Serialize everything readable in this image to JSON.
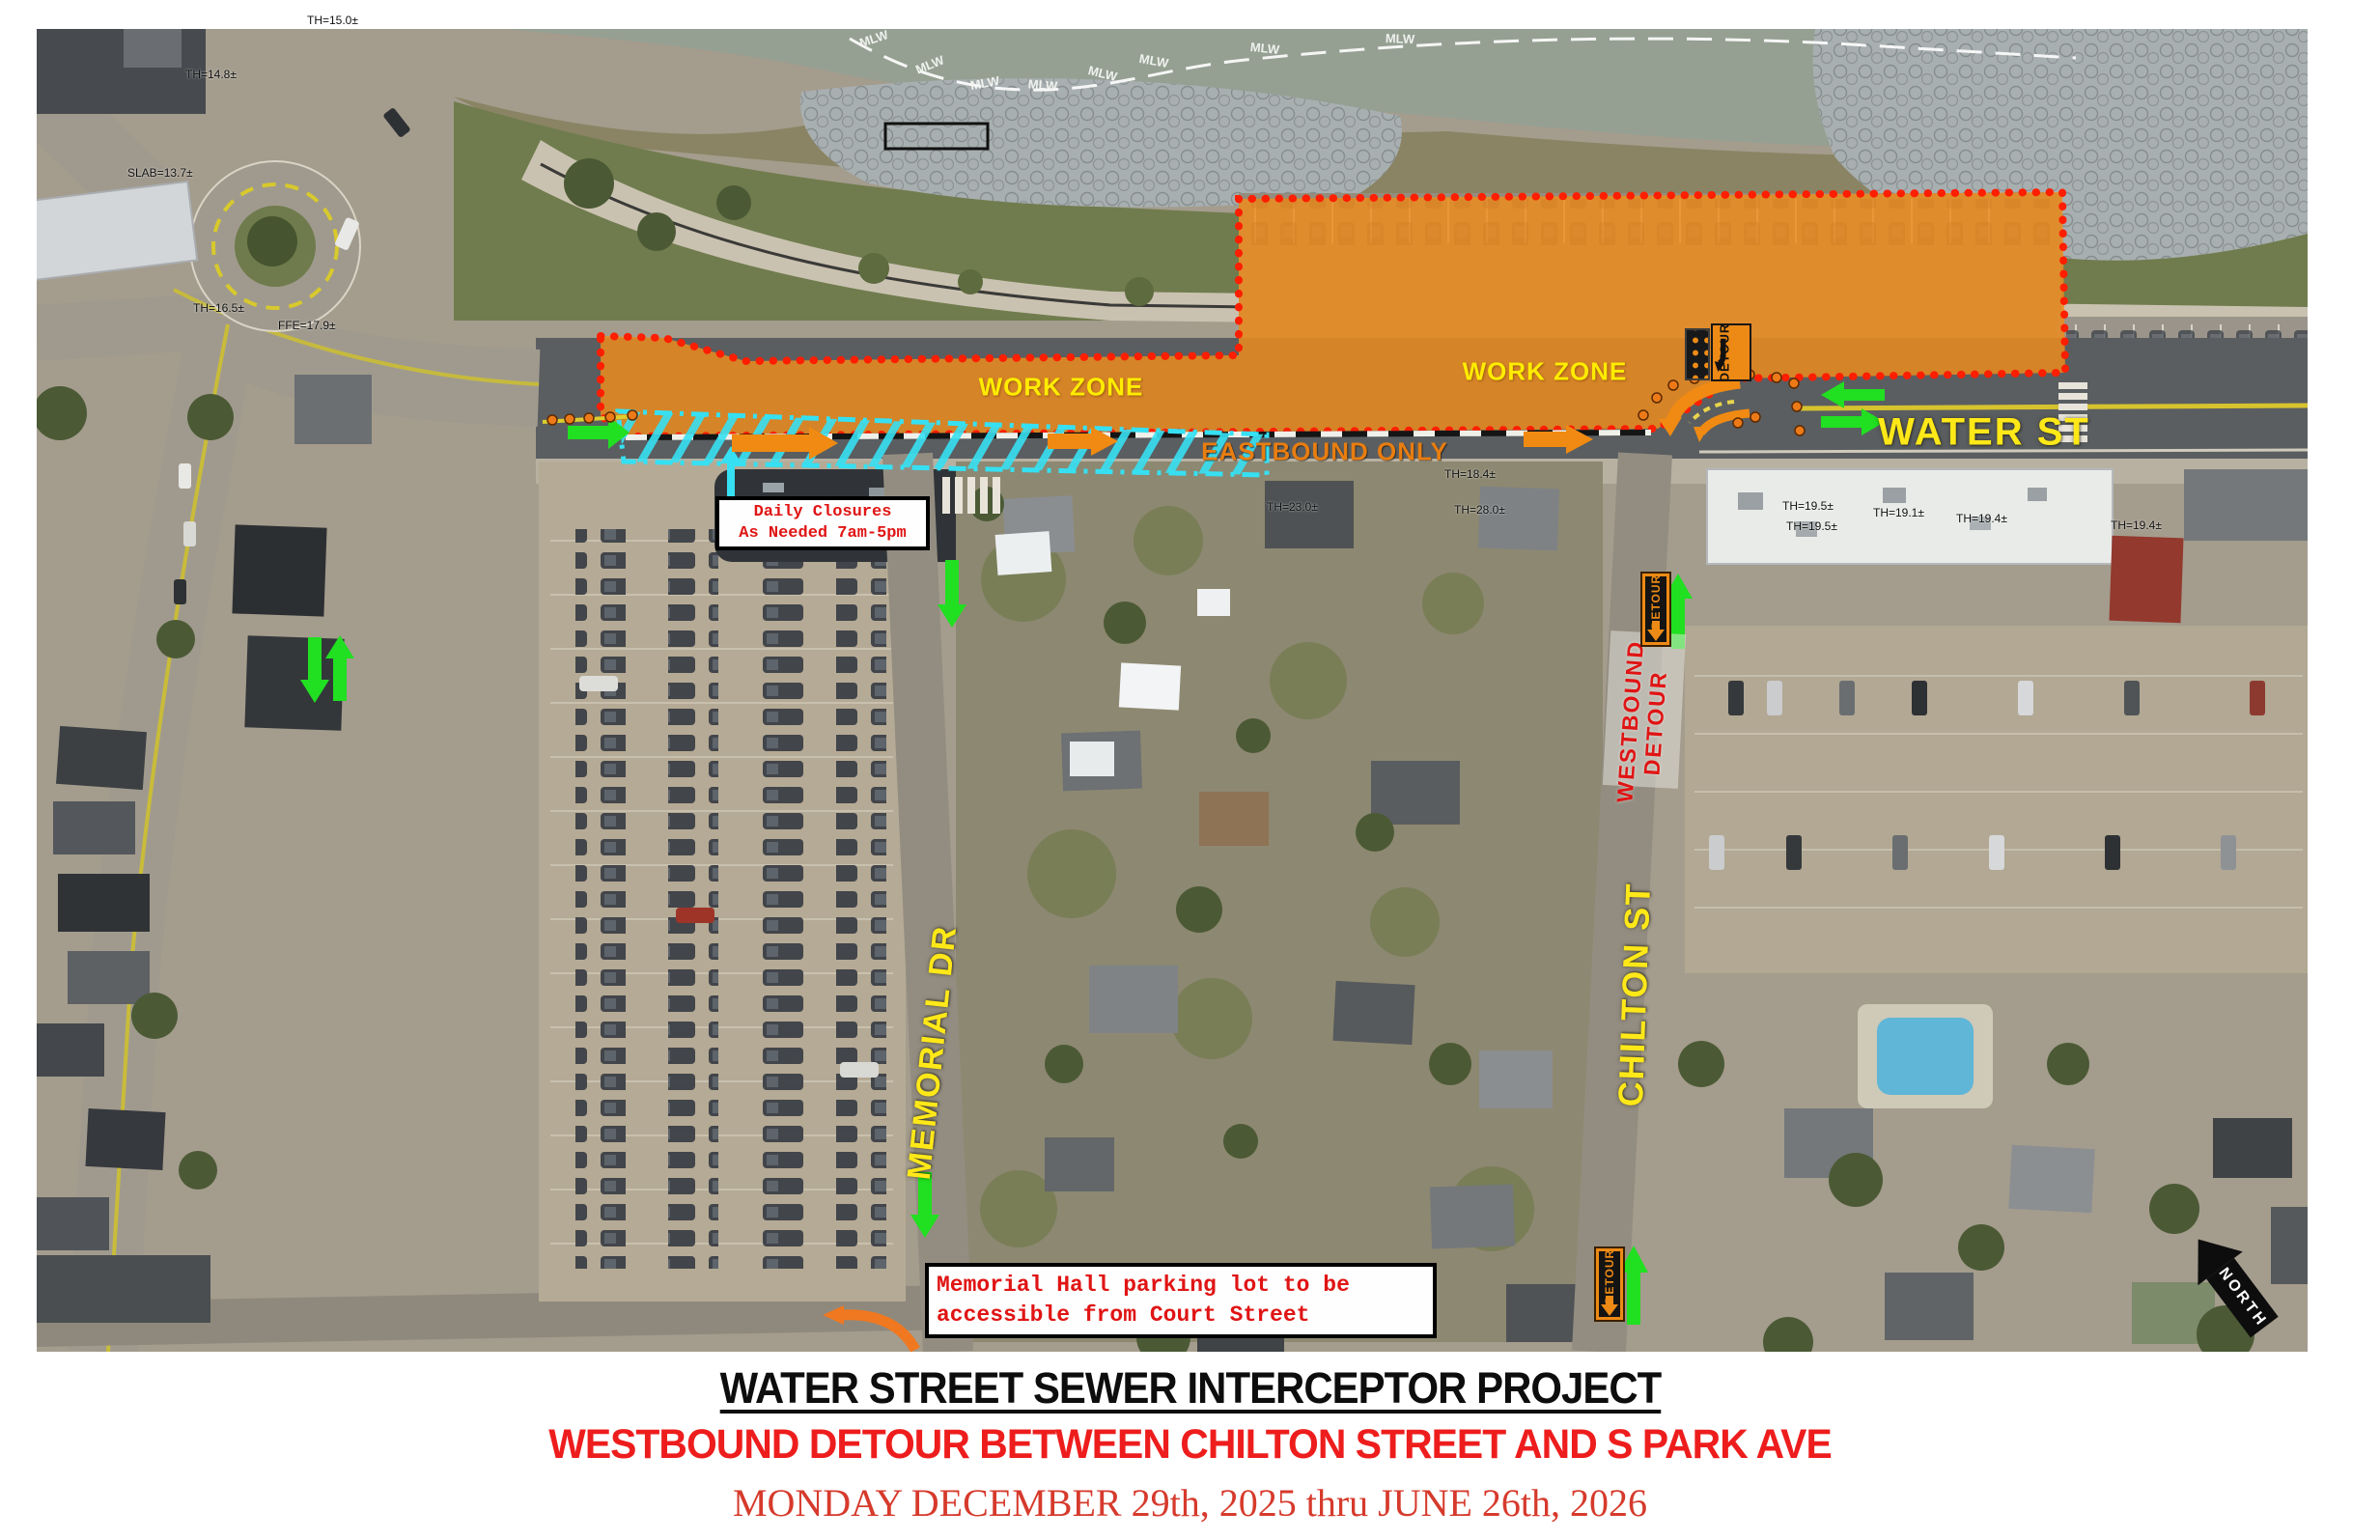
{
  "footer": {
    "title": "WATER STREET SEWER INTERCEPTOR PROJECT",
    "subtitle": "WESTBOUND DETOUR BETWEEN CHILTON STREET AND S PARK AVE",
    "date_range": "MONDAY DECEMBER 29th, 2025 thru JUNE 26th, 2026"
  },
  "map": {
    "street_labels": {
      "water_st": "WATER ST",
      "memorial_dr": "MEMORIAL DR",
      "chilton_st": "CHILTON ST"
    },
    "zone_labels": {
      "work_zone_west": "WORK ZONE",
      "work_zone_east": "WORK ZONE",
      "eastbound_only": "EASTBOUND ONLY"
    },
    "detour": {
      "westbound_line1": "WESTBOUND",
      "westbound_line2": "DETOUR",
      "sign_label": "DETOUR"
    },
    "notes": {
      "daily_closures_line1": "Daily Closures",
      "daily_closures_line2": "As Needed 7am-5pm",
      "memorial_hall_line1": "Memorial Hall parking lot to be",
      "memorial_hall_line2": "accessible from Court Street"
    },
    "compass": {
      "north": "NORTH"
    },
    "water_line_label": "MLW",
    "survey_labels": [
      "TH=15.0±",
      "TH=14.8±",
      "SLAB=13.7±",
      "TH=16.5±",
      "FFE=17.9±",
      "TH=23.0±",
      "TH=18.4±",
      "TH=28.0±",
      "TH=19.5±",
      "TH=19.5±",
      "TH=19.1±",
      "TH=19.4±",
      "TH=19.4±"
    ]
  },
  "colors": {
    "work_zone_orange": "#ED8C1E",
    "closure_border_red": "#FF1E00",
    "buffer_hatch_cyan": "#36E0F2",
    "traffic_arrow_green": "#21DF21",
    "street_label_yellow": "#FFE818",
    "note_text_red": "#E01414",
    "title_red": "#EE1D1D",
    "date_red": "#D63A2C"
  }
}
